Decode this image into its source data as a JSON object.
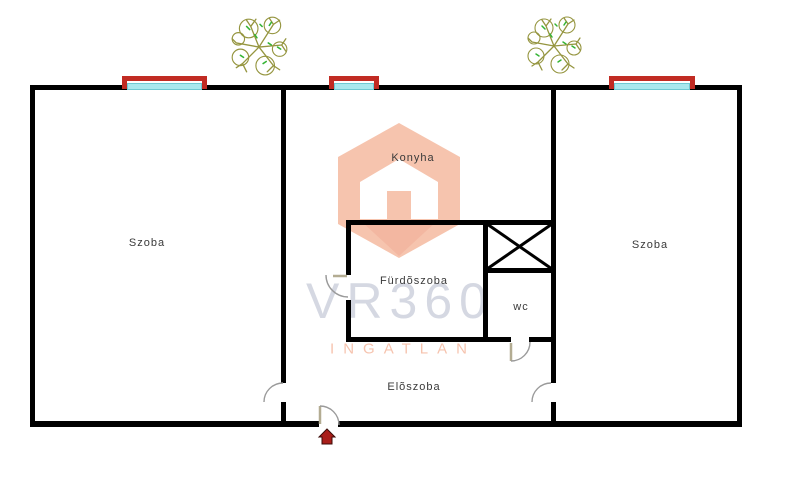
{
  "page": {
    "background": "#ffffff"
  },
  "floorplan": {
    "rooms": {
      "szoba_left": "Szoba",
      "konyha": "Konyha",
      "szoba_right": "Szoba",
      "furdoszoba": "Fürdõszoba",
      "wc": "wc",
      "eloszoba": "Elõszoba"
    },
    "watermark": {
      "brand": "VR360",
      "subtitle": "INGATLAN"
    },
    "features": {
      "windows": 3,
      "trees": 2,
      "shaft": "x-crossed-duct",
      "entrance": "bottom-center-door-with-red-marker"
    },
    "colors": {
      "wall": "#000000",
      "window_frame": "#c12b23",
      "window_glass": "#a9e8ee",
      "window_glass_edge": "#6fc9d2",
      "door_arc": "#9a9a9a",
      "door_leaf": "#b3ac92",
      "watermark_text": "#d5d8e2",
      "watermark_accent": "#f6c3ae",
      "logo_hex": "#f6c4ae",
      "logo_shadow": "#f3b7a1",
      "entrance_marker": "#a91e1a",
      "tree_branch": "#95953f",
      "tree_leaf": "#35b435",
      "label_text": "#3a3a3a"
    }
  }
}
